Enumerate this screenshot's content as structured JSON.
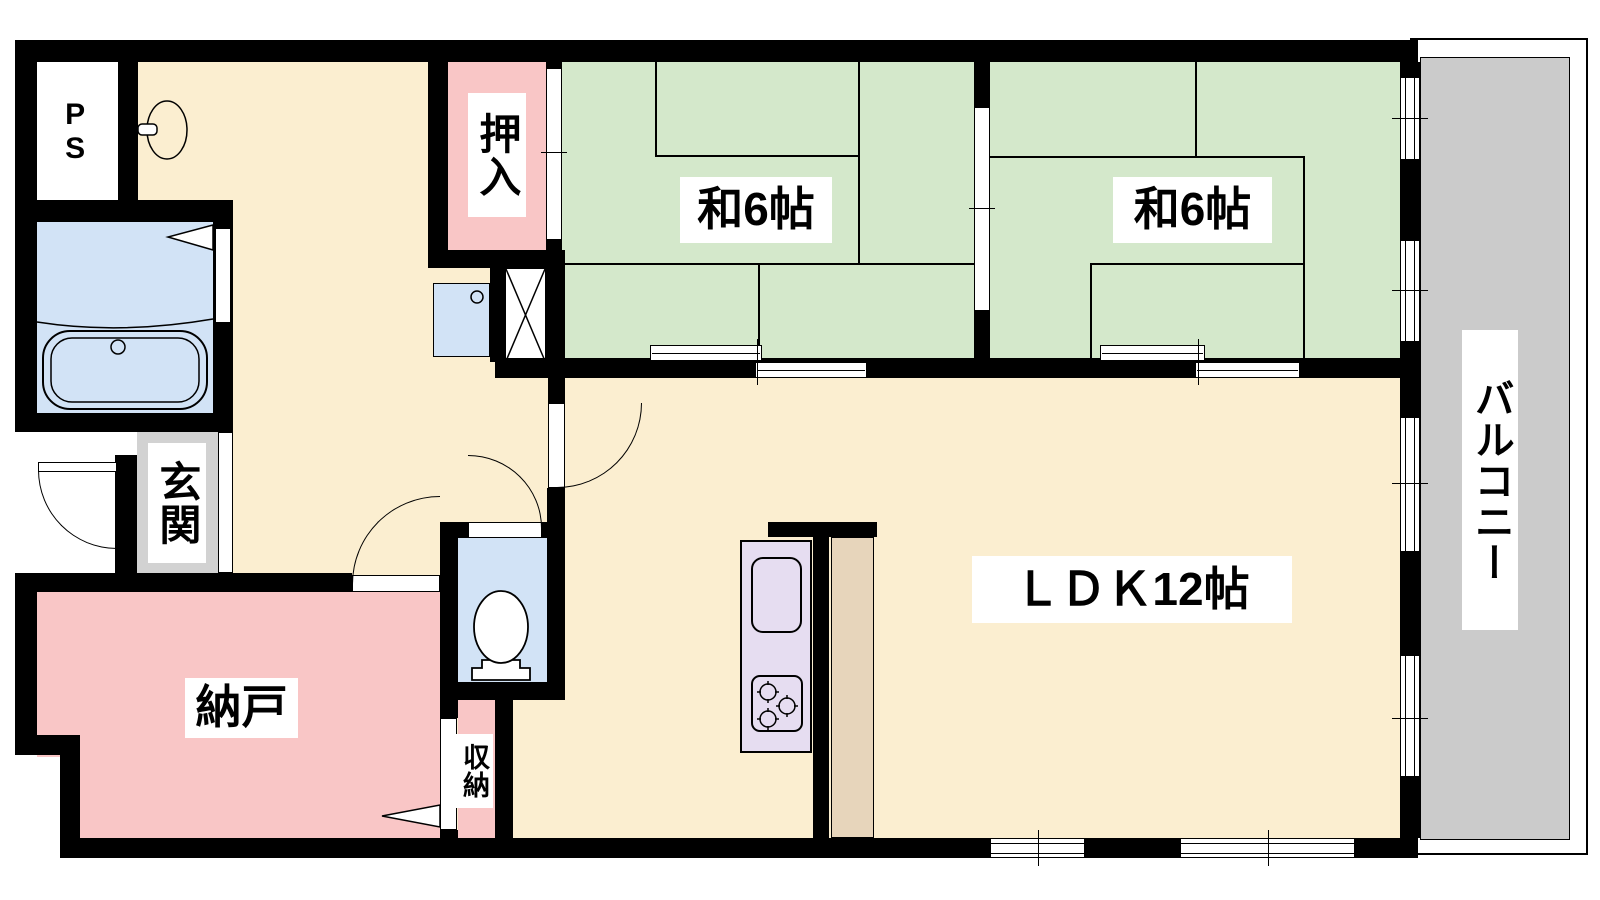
{
  "plan_title": "2LDK apartment floor plan",
  "rooms": {
    "ps": {
      "label": "PS"
    },
    "oshiire": {
      "label": "押入"
    },
    "washitsu1": {
      "label": "和6帖"
    },
    "washitsu2": {
      "label": "和6帖"
    },
    "balcony": {
      "label": "バルコニー"
    },
    "ldk": {
      "label": "ＬＤＫ12帖"
    },
    "genkan": {
      "label": "玄関"
    },
    "nando": {
      "label": "納戸"
    },
    "shuno": {
      "label": "収納"
    }
  },
  "fixtures": [
    "bathtub",
    "washbasin",
    "washing-machine-pan",
    "toilet",
    "kitchen-sink",
    "stove",
    "duct-shaft"
  ],
  "colors": {
    "wall": "#000000",
    "floor": "#FBEED0",
    "tatami": "#D4E8CB",
    "pink": "#F9C6C6",
    "blue": "#D2E3F6",
    "gray": "#D2D2D2",
    "balconygray": "#CBCBCB",
    "lavender": "#E6DDF1",
    "tan": "#E7D5BB"
  }
}
